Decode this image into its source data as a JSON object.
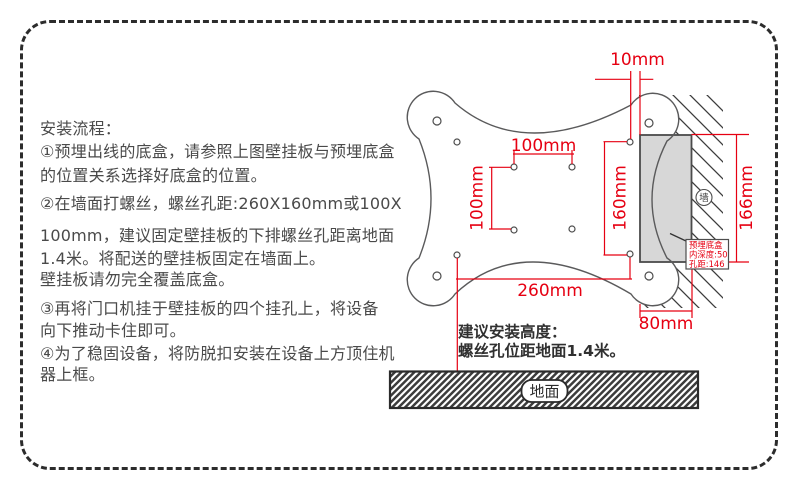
{
  "colors": {
    "dimension_red": "#e60012",
    "instruction_text": "#4a4a4a",
    "wall_box_fill": "#d7d7d7",
    "outline_gray": "#5a5a5b"
  },
  "instructions": {
    "lines": [
      "安装流程：",
      "①预埋出线的底盒，请参照上图壁挂板与预埋底盒",
      "的位置关系选择好底盒的位置。",
      "②在墙面打螺丝，螺丝孔距:260X160mm或100X",
      "100mm，建议固定壁挂板的下排螺丝孔距离地面",
      "1.4米。将配送的壁挂板固定在墙面上。",
      "壁挂板请勿完全覆盖底盒。",
      "③再将门口机挂于壁挂板的四个挂孔上，将设备",
      "向下推动卡住即可。",
      "④为了稳固设备，将防脱扣安装在设备上方顶住机",
      "器上框。"
    ]
  },
  "diagram": {
    "dimensions": {
      "top_offset": "10mm",
      "vesa_width": "100mm",
      "vesa_height": "100mm",
      "outer_hole_height": "160mm",
      "outer_hole_width": "260mm",
      "wall_box_height": "166mm",
      "wall_box_width": "80mm"
    },
    "wall_label": "墙",
    "embedded_box_label": {
      "line1": "预埋底盒",
      "line2": "内深度:50",
      "line3": "孔距:146"
    },
    "height_note": {
      "line1": "建议安装高度：",
      "line2": "螺丝孔位距地面1.4米。"
    },
    "ground_label": "地面"
  }
}
